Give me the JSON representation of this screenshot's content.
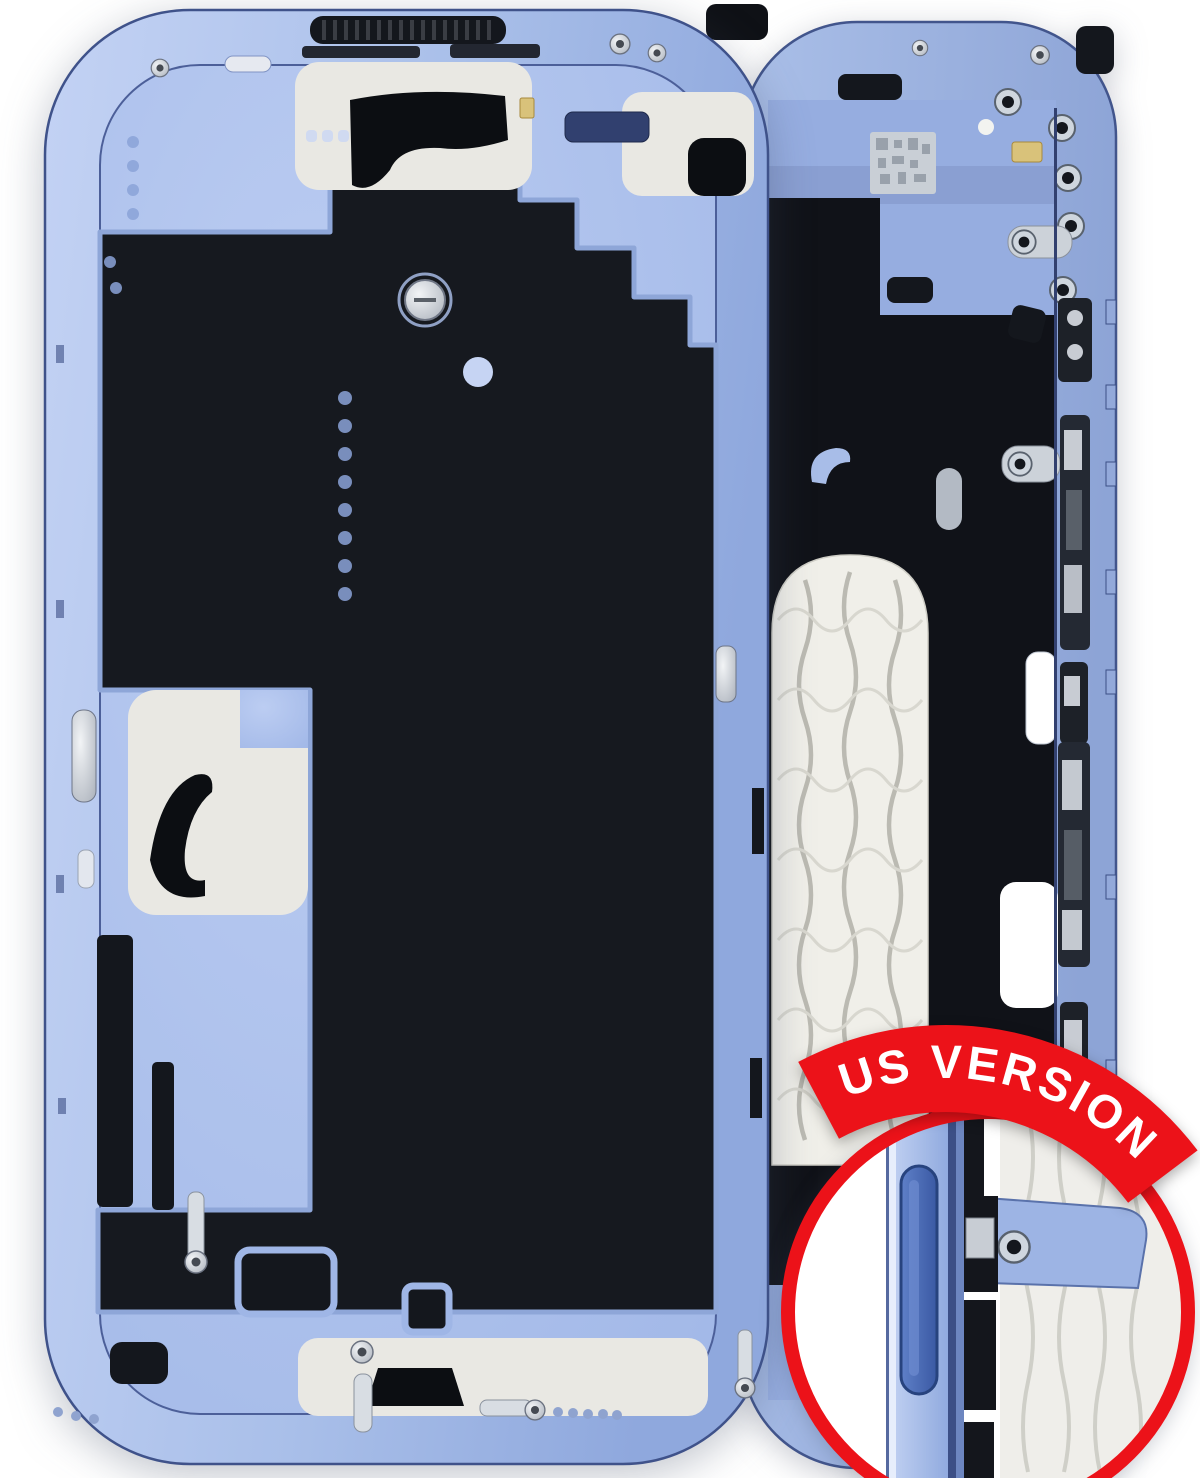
{
  "image": {
    "subject": "phone-midframe-housing-blue",
    "badge": {
      "label": "US VERSION",
      "background": "#EC1219",
      "text_color": "#FFFFFF"
    },
    "inset": {
      "ring_color": "#EC1219",
      "background": "#FFFFFF",
      "feature": "side-button-detail"
    },
    "colors": {
      "frame_blue": "#A9BFE9",
      "frame_blue_dark": "#8FA8DD",
      "frame_edge": "#42558C",
      "plate_blue": "#AFC3ED",
      "panel_dark": "#16191F",
      "cutout_white": "#E9E8E3",
      "coil_white": "#F0EFE9",
      "screw_silver": "#D8DDE3",
      "background": "#FFFFFF"
    }
  }
}
